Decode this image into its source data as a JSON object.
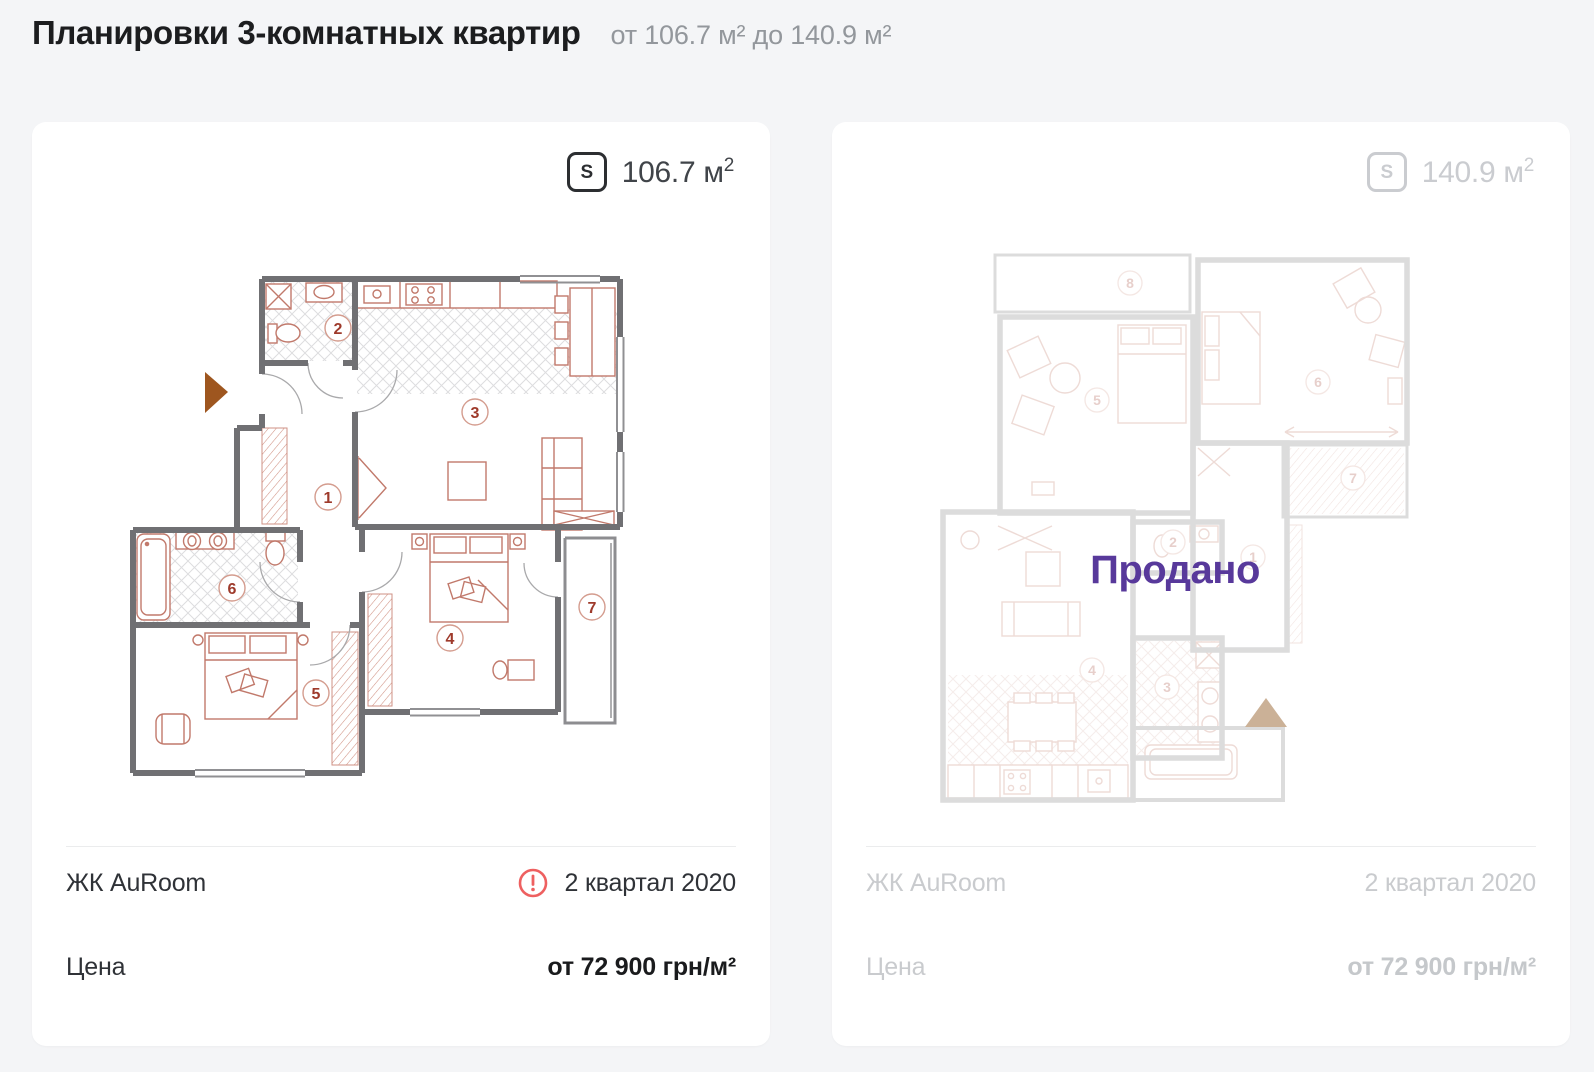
{
  "header": {
    "title": "Планировки 3-комнатных квартир",
    "subtitle": "от 106.7 м² до 140.9 м²"
  },
  "cards": [
    {
      "area_icon_label": "S",
      "area_value": "106.7 м",
      "area_sup": "2",
      "complex": "ЖК AuRoom",
      "term": "2 квартал 2020",
      "price_label": "Цена",
      "price": "от 72 900 грн/м²",
      "sold": false
    },
    {
      "area_icon_label": "S",
      "area_value": "140.9 м",
      "area_sup": "2",
      "complex": "ЖК AuRoom",
      "term": "2 квартал 2020",
      "price_label": "Цена",
      "price": "от 72 900 грн/м²",
      "sold": true,
      "sold_label": "Продано"
    }
  ],
  "plans": {
    "left": {
      "room_numbers": [
        "1",
        "2",
        "3",
        "4",
        "5",
        "6",
        "7"
      ]
    },
    "right": {
      "room_numbers": [
        "1",
        "2",
        "3",
        "4",
        "5",
        "6",
        "7",
        "8"
      ]
    }
  },
  "colors": {
    "page_bg": "#f4f5f7",
    "sold_accent": "#58399b",
    "warning": "#ee6060",
    "walls": "#707073",
    "furniture": "#c1796b",
    "entrance_arrow": "#9e561f"
  }
}
